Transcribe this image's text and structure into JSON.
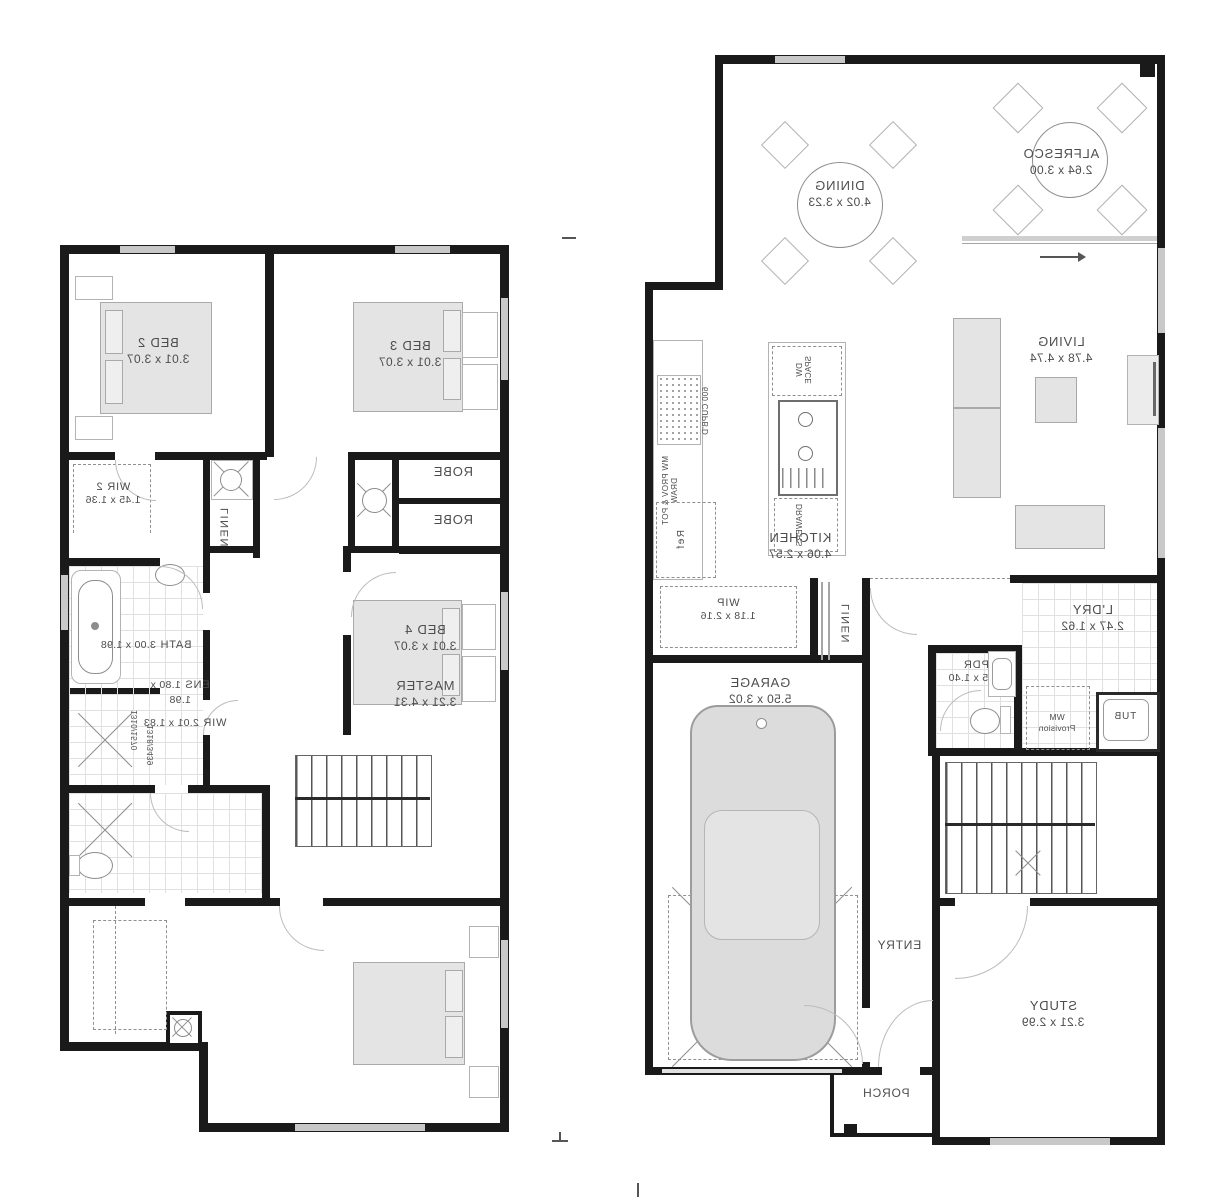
{
  "ground_floor": {
    "rooms": {
      "alfresco": {
        "name": "ALFRESCO",
        "dims": "2.64 x 3.00"
      },
      "dining": {
        "name": "DINING",
        "dims": "4.02 x 3.23"
      },
      "living": {
        "name": "LIVING",
        "dims": "4.78 x 4.74"
      },
      "kitchen": {
        "name": "KITCHEN",
        "dims": "4.06 x 2.57"
      },
      "wip": {
        "name": "WIP",
        "dims": "1.18 x 2.16"
      },
      "linen": {
        "name": "LINEN"
      },
      "ldry": {
        "name": "L'DRY",
        "dims": "2.47 x 1.62"
      },
      "pdr": {
        "name": "PDR",
        "dims": "1.45 x 1.40"
      },
      "garage": {
        "name": "GARAGE",
        "dims": "5.50 x 3.02"
      },
      "entry": {
        "name": "ENTRY"
      },
      "study": {
        "name": "STUDY",
        "dims": "3.21 x 2.99"
      },
      "porch": {
        "name": "PORCH"
      }
    },
    "annotations": {
      "cupboard": "600 CUPB'D",
      "dw_space": "DW SPACE",
      "drawers": "DRAWERS",
      "mw_prov": "MW PROV & POT DRAW",
      "fridge": "Ref",
      "wm_line1": "WM",
      "wm_line2": "Provision",
      "tub": "TUB"
    }
  },
  "upper_floor": {
    "rooms": {
      "bed2": {
        "name": "BED 2",
        "dims": "3.01 x 3.07"
      },
      "bed3": {
        "name": "BED 3",
        "dims": "3.01 x 3.07"
      },
      "bed4": {
        "name": "BED 4",
        "dims": "3.01 x 3.07"
      },
      "master": {
        "name": "MASTER",
        "dims": "3.21 x 4.31"
      },
      "bath": {
        "name": "BATH",
        "dims": "3.00 x 1.98"
      },
      "ens": {
        "name": "ENS",
        "dims": "1.80 x 1.98"
      },
      "wir": {
        "name": "WIR",
        "dims": "2.01 x 1.83"
      },
      "wir2": {
        "name": "WIR 2",
        "dims": "1.45 x 1.36"
      },
      "linen": {
        "name": "LINEN"
      },
      "robe_top": {
        "name": "ROBE"
      },
      "robe_bottom": {
        "name": "ROBE"
      }
    },
    "annotations": {
      "note1": "1310/1570",
      "note2": "1318/3439"
    }
  }
}
